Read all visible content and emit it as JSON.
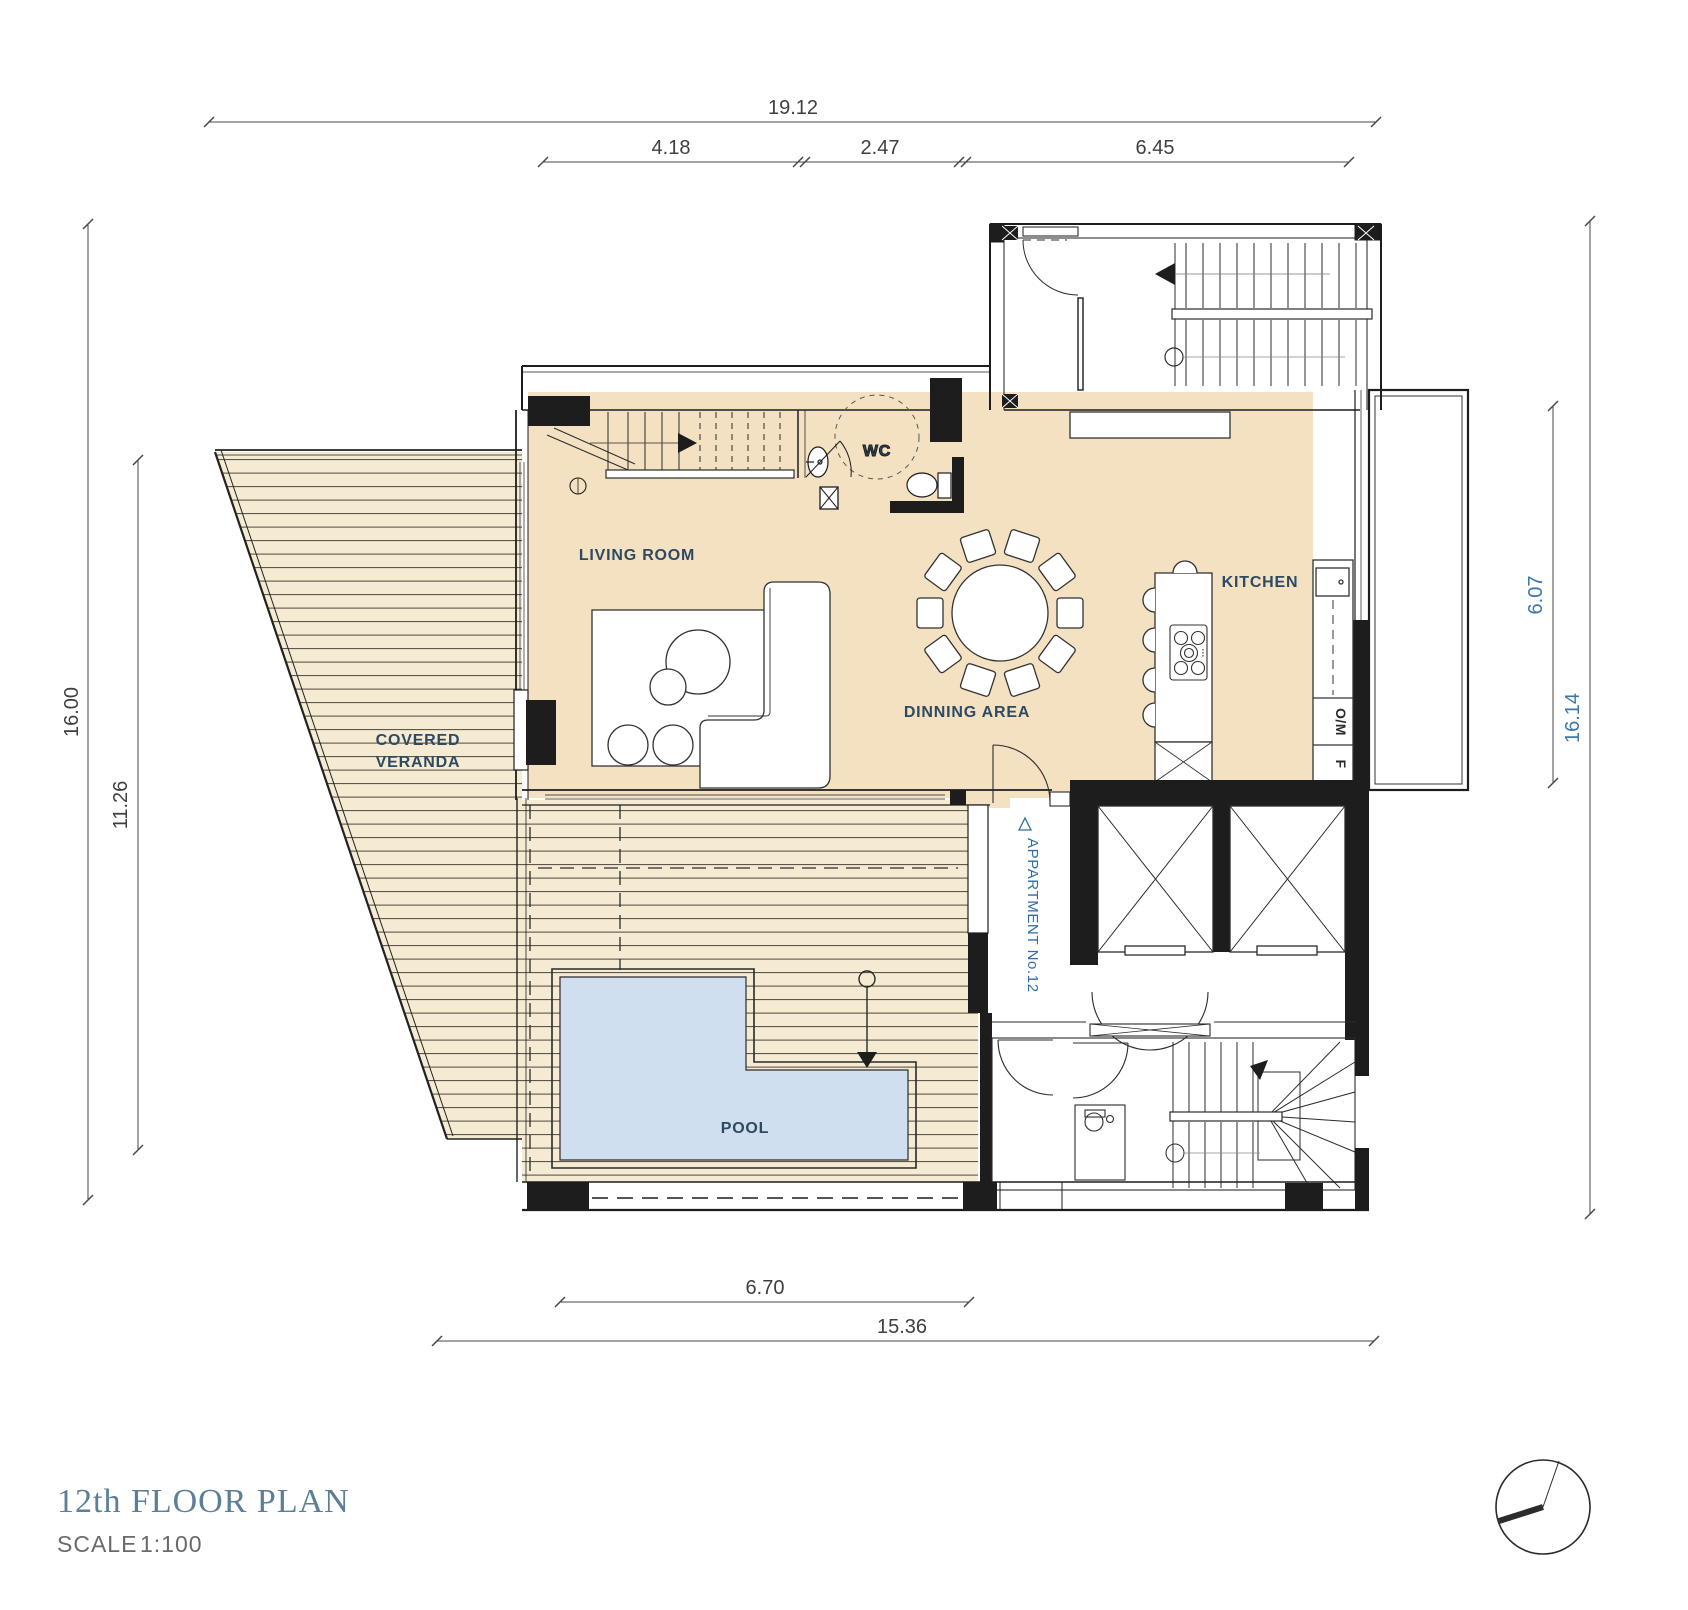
{
  "title_block": {
    "title": "12th FLOOR PLAN",
    "scale_label": "SCALE",
    "scale_value": "1:100"
  },
  "rooms": {
    "living_room": "LIVING ROOM",
    "wc": "WC",
    "kitchen": "KITCHEN",
    "dining": "DINNING AREA",
    "veranda_line1": "COVERED",
    "veranda_line2": "VERANDA",
    "pool": "POOL",
    "apartment": "APPARTMENT No.12"
  },
  "appliances": {
    "oven_microwave": "O/M",
    "fridge": "F"
  },
  "dimensions": {
    "top_overall": "19.12",
    "top_segments": [
      "4.18",
      "2.47",
      "6.45"
    ],
    "left_outer": "16.00",
    "left_inner": "11.26",
    "right_inner": "6.07",
    "right_outer": "16.14",
    "bottom_inner": "6.70",
    "bottom_outer": "15.36"
  },
  "colors": {
    "floor_beige": "#f3e1c1",
    "deck_beige": "#f5ebd3",
    "pool_blue": "#cfdfef",
    "wall_black": "#1d1d1d",
    "room_label_navy": "#2d4a63",
    "accent_blue": "#3a77ad",
    "title_blue": "#5c7f97",
    "dim_gray": "#3f3f3f"
  }
}
